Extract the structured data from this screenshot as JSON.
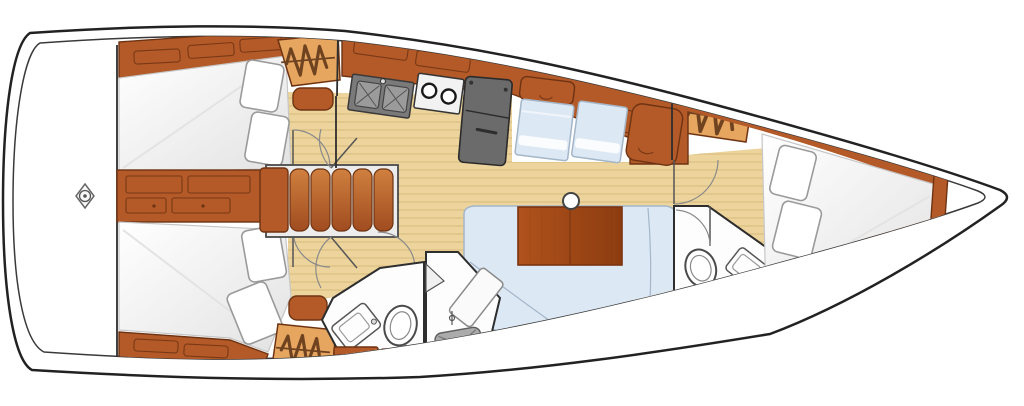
{
  "diagram": {
    "kind": "sailboat-interior-floor-plan",
    "orientation": {
      "bow": "right",
      "stern": "left"
    }
  },
  "regions": {
    "stern_platform": "stern platform",
    "aft_cabin_port": "aft cabin with double berth (top)",
    "aft_cabin_starboard": "aft cabin with double berth (bottom)",
    "companionway": "companionway steps",
    "galley": "galley with double sink, two-burner stove and refrigerator",
    "saloon": "saloon with settees and table",
    "aft_heads": "aft heads with toilet, sink and shower",
    "forward_heads": "forward heads with toilet, sink and shower",
    "forward_cabin": "forward cabin with double berth",
    "bow_locker": "bow anchor locker",
    "hanging_locker": "hanging locker",
    "mast_post": "mast support post",
    "windlass": "stern fitting"
  },
  "icons": {
    "coil_symbol": "hanging-locker-coil",
    "shower_tray": "shower-drain-cross",
    "burners": "stove-burner-circles"
  },
  "colors": {
    "bg": "#ffffff",
    "hullLine": "#222222",
    "innerLine": "#3a3a3a",
    "wall": "#2e2e2e",
    "wood": "#b35a28",
    "woodDark": "#6e3312",
    "woodLight": "#cd7a40",
    "lockerTan": "#e7a660",
    "coil": "#6f4320",
    "floor": "#ecd49c",
    "floorGrain": "#d8ba7e",
    "settee": "#dce8f4",
    "setteeEdge": "#a4b6c8",
    "pillowEdge": "#9a9a9a",
    "fixture": "#4a4a4a",
    "grayFill": "#ababab",
    "grayEdge": "#5f5f5f",
    "appliance": "#6b6b6b",
    "applianceDark": "#2b2b2b",
    "sinkBasin": "#9b9b9b",
    "headsFloor": "#fdfdfd",
    "door": "#8a8a8a",
    "table": "#a84e1c",
    "tableDark": "#7c3410"
  }
}
